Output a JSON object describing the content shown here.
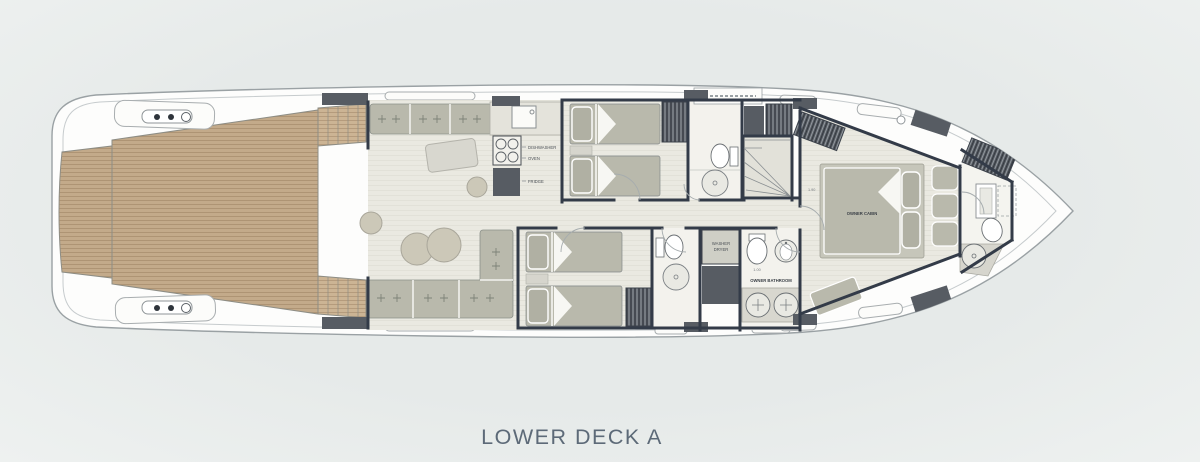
{
  "title": "LOWER DECK A",
  "deck_plan": {
    "labels": {
      "dishwasher": "DISHWASHER",
      "oven": "OVEN",
      "fridge": "FRIDGE",
      "washer_line1": "WASHER",
      "washer_line2": "DRYER",
      "owner_bathroom": "OWNER BATHROOM",
      "owner_cabin": "OWNER CABIN",
      "dim_owner_bath": "1.00",
      "dim_owner_cabin": "1.90"
    },
    "colors": {
      "background": "#e8eceb",
      "hull": "#fdfdfc",
      "hull_stroke": "#9aa1a4",
      "teak_deck": "#c3aa8a",
      "interior_floor": "#eae9e1",
      "furniture": "#b9b9ac",
      "counter": "#d8d7cf",
      "walls": "#333b48",
      "bulkhead_blocks": "#575c63",
      "title_text": "#5d6a78"
    }
  }
}
